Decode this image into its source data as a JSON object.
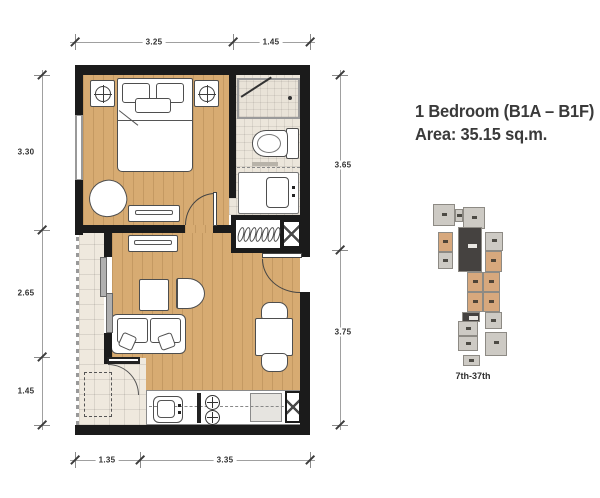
{
  "title": {
    "line1": "1 Bedroom (B1A – B1F)",
    "line2": "Area: 35.15 sq.m."
  },
  "dimensions": {
    "top": [
      "3.25",
      "1.45"
    ],
    "left": [
      "3.30",
      "2.65",
      "1.45"
    ],
    "right": [
      "3.65",
      "3.75"
    ],
    "bottom": [
      "1.35",
      "3.35"
    ]
  },
  "keyplan": {
    "label": "7th-37th",
    "colors": {
      "unit": "#cdcac4",
      "highlight": "#d7a87d",
      "core": "#454240",
      "outline": "#8d8a84"
    },
    "blocks": [
      {
        "x": 5,
        "y": 12,
        "w": 22,
        "h": 22,
        "t": "u"
      },
      {
        "x": 27,
        "y": 17,
        "w": 8,
        "h": 13,
        "t": "u"
      },
      {
        "x": 35,
        "y": 15,
        "w": 22,
        "h": 22,
        "t": "u"
      },
      {
        "x": 10,
        "y": 40,
        "w": 15,
        "h": 20,
        "t": "h"
      },
      {
        "x": 10,
        "y": 60,
        "w": 15,
        "h": 17,
        "t": "u"
      },
      {
        "x": 30,
        "y": 35,
        "w": 24,
        "h": 45,
        "t": "c"
      },
      {
        "x": 57,
        "y": 40,
        "w": 18,
        "h": 19,
        "t": "u"
      },
      {
        "x": 57,
        "y": 59,
        "w": 17,
        "h": 21,
        "t": "h"
      },
      {
        "x": 39,
        "y": 80,
        "w": 16,
        "h": 20,
        "t": "h"
      },
      {
        "x": 55,
        "y": 80,
        "w": 17,
        "h": 20,
        "t": "h"
      },
      {
        "x": 39,
        "y": 100,
        "w": 16,
        "h": 20,
        "t": "h"
      },
      {
        "x": 55,
        "y": 100,
        "w": 17,
        "h": 20,
        "t": "h"
      },
      {
        "x": 34,
        "y": 120,
        "w": 18,
        "h": 10,
        "t": "c"
      },
      {
        "x": 30,
        "y": 129,
        "w": 20,
        "h": 15,
        "t": "u"
      },
      {
        "x": 30,
        "y": 144,
        "w": 20,
        "h": 15,
        "t": "u"
      },
      {
        "x": 57,
        "y": 120,
        "w": 17,
        "h": 17,
        "t": "u"
      },
      {
        "x": 57,
        "y": 140,
        "w": 22,
        "h": 24,
        "t": "u"
      },
      {
        "x": 35,
        "y": 163,
        "w": 17,
        "h": 11,
        "t": "u"
      }
    ]
  },
  "colors": {
    "wall": "#1b1b1b",
    "wood_floor": "#d7ab72",
    "bath_tile": "#ece6db",
    "balcony_tile": "#efe9de",
    "highlight": "#d7a87d"
  }
}
